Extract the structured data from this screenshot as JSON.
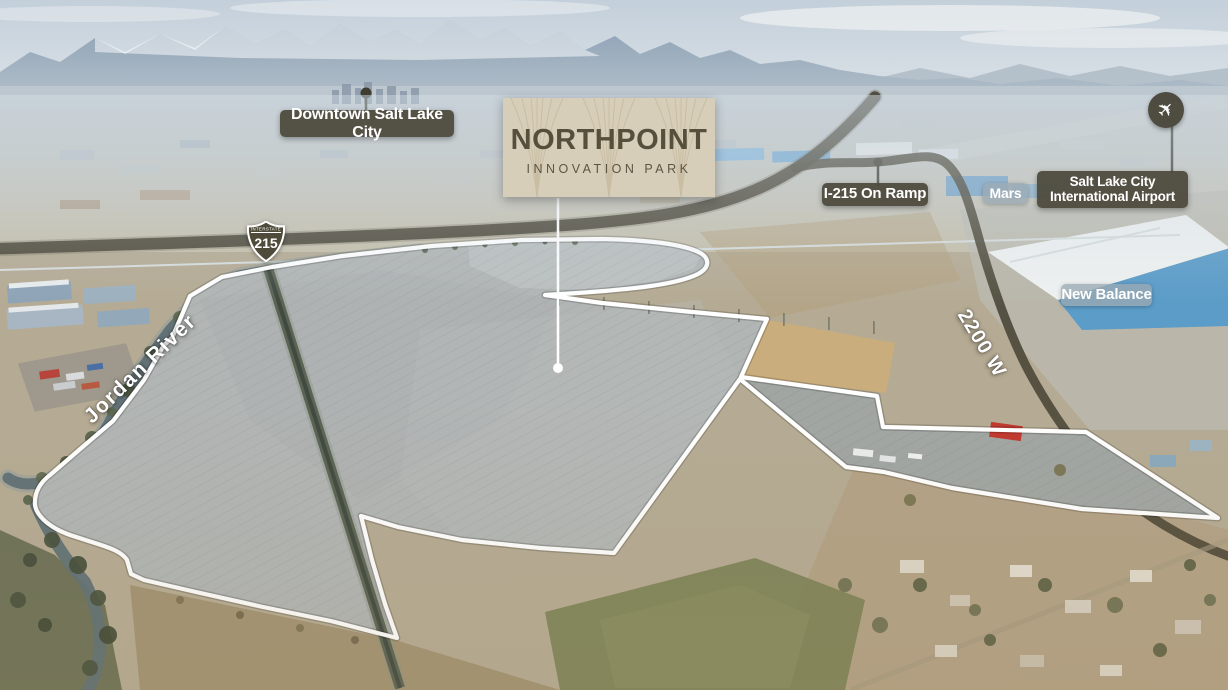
{
  "sign": {
    "title": "NORTHPOINT",
    "subtitle": "INNOVATION PARK"
  },
  "shield": {
    "top": "INTERSTATE",
    "number": "215"
  },
  "labels": {
    "downtown": "Downtown Salt Lake City",
    "on_ramp": "I-215 On Ramp",
    "mars": "Mars",
    "airport_line1": "Salt Lake City",
    "airport_line2": "International Airport",
    "new_balance": "New Balance",
    "road_2200w": "2200 W",
    "jordan_river": "Jordan River"
  },
  "icons": {
    "airplane": "✈"
  },
  "colors": {
    "label_dark_bg": "#4b483a",
    "label_light_bg": "#9aa9b3",
    "sign_bg": "#d7ceba",
    "sign_text": "#564f3b",
    "boundary": "#ffffff",
    "road_overlay": "#4b4737"
  }
}
